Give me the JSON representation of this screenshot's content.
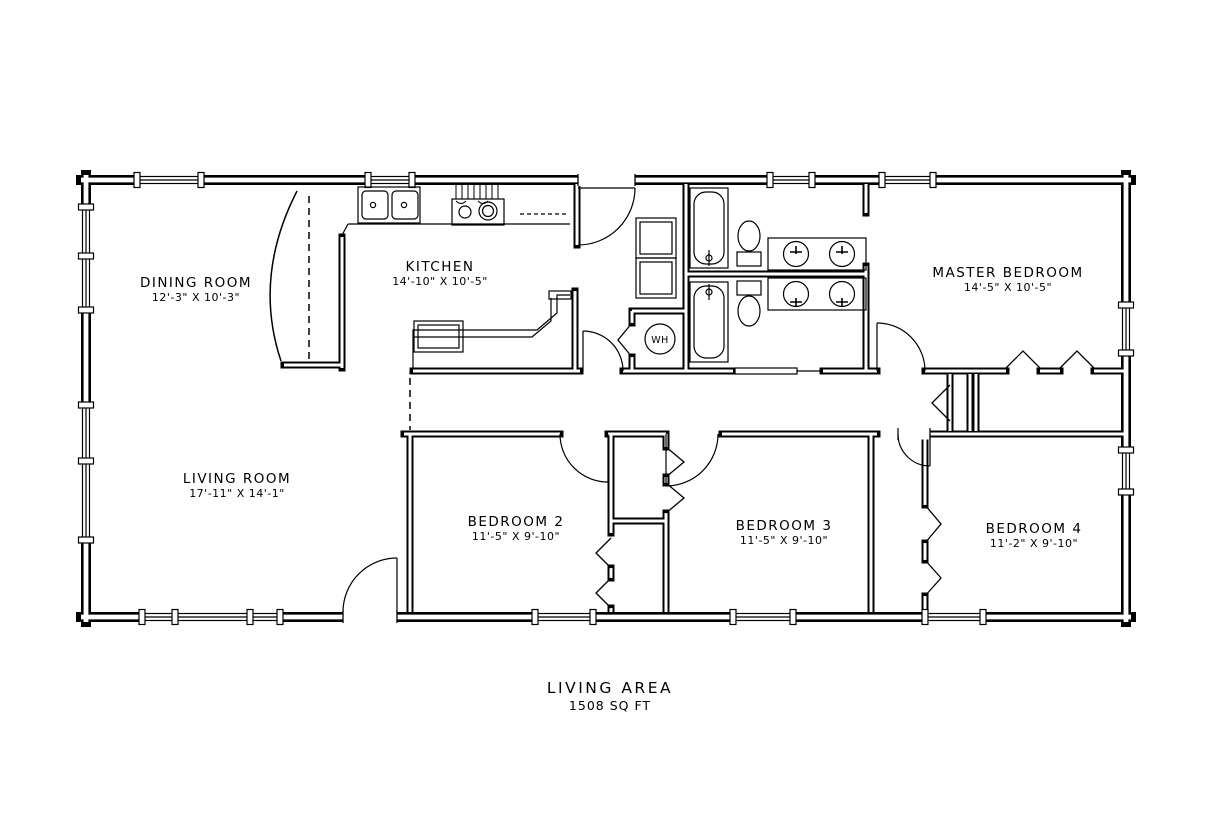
{
  "drawing": {
    "type": "residential floor plan",
    "colors": {
      "line": "#000000",
      "background": "#ffffff"
    }
  },
  "rooms": [
    {
      "name": "DINING ROOM",
      "dimensions": "12'-3\" X 10'-3\""
    },
    {
      "name": "KITCHEN",
      "dimensions": "14'-10\" X 10'-5\""
    },
    {
      "name": "MASTER BEDROOM",
      "dimensions": "14'-5\" X 10'-5\""
    },
    {
      "name": "LIVING ROOM",
      "dimensions": "17'-11\" X 14'-1\""
    },
    {
      "name": "BEDROOM 2",
      "dimensions": "11'-5\" X 9'-10\""
    },
    {
      "name": "BEDROOM 3",
      "dimensions": "11'-5\" X 9'-10\""
    },
    {
      "name": "BEDROOM 4",
      "dimensions": "11'-2\" X 9'-10\""
    }
  ],
  "fixtures": {
    "water_heater": "WH"
  },
  "summary": {
    "title": "LIVING AREA",
    "value": "1508 SQ FT"
  }
}
